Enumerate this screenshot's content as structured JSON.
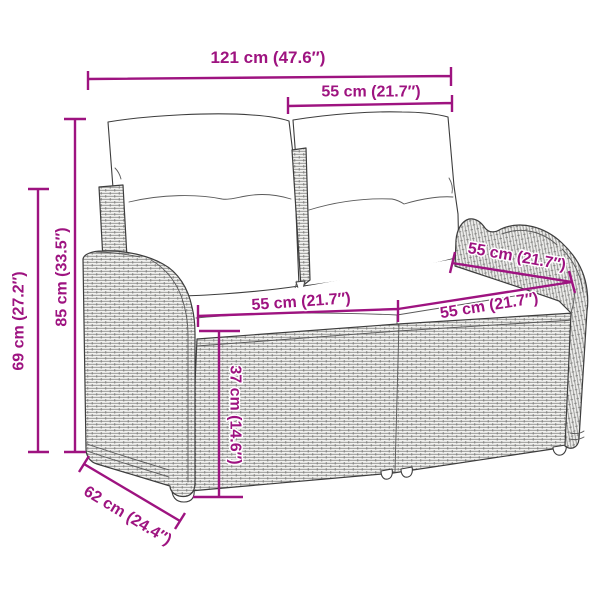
{
  "diagram": {
    "illustration": "poly-rattan-two-seater-garden-bench-with-cushions",
    "background": "#ffffff",
    "accent_color": "#9e1380",
    "line_color": "#3d3d3d",
    "dimensions": {
      "overall_width": "121 cm (47.6″)",
      "backrest_width": "55 cm (21.7″)",
      "total_height": "85 cm (33.5″)",
      "armrest_height": "69 cm (27.2″)",
      "seat_width_left": "55 cm (21.7″)",
      "seat_width_right": "55 cm (21.7″)",
      "seat_depth": "55 cm (21.7″)",
      "seat_front_height": "37 cm (14.6″)",
      "overall_depth": "62 cm (24.4″)"
    }
  }
}
